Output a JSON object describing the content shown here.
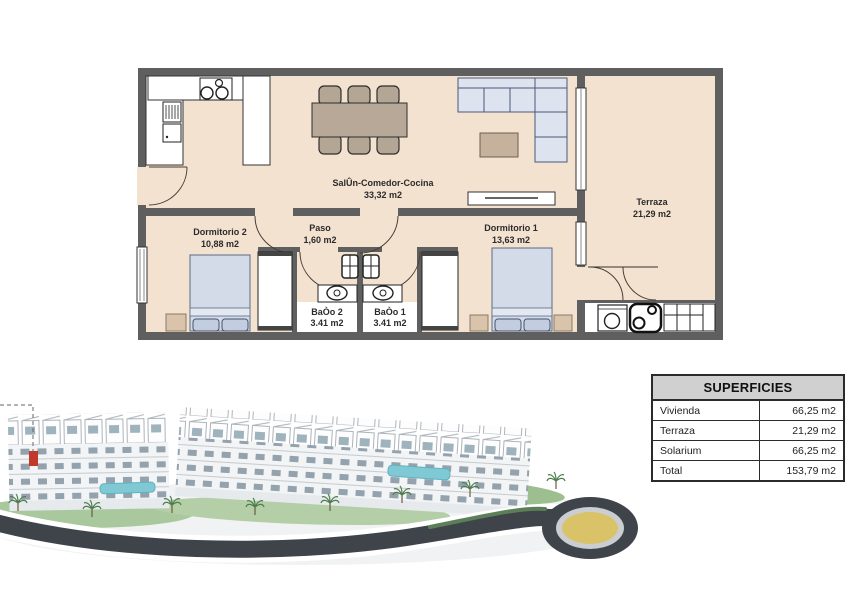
{
  "plan": {
    "rooms": {
      "salon": {
        "name": "SalÛn-Comedor-Cocina",
        "area": "33,32 m2"
      },
      "paso": {
        "name": "Paso",
        "area": "1,60 m2"
      },
      "dormitorio2": {
        "name": "Dormitorio 2",
        "area": "10,88 m2"
      },
      "dormitorio1": {
        "name": "Dormitorio 1",
        "area": "13,63 m2"
      },
      "bano2": {
        "name": "BaÒo 2",
        "area": "3.41 m2"
      },
      "bano1": {
        "name": "BaÒo 1",
        "area": "3.41 m2"
      },
      "terraza": {
        "name": "Terraza",
        "area": "21,29 m2"
      }
    }
  },
  "superficies_table": {
    "title": "SUPERFICIES",
    "rows": [
      {
        "label": "Vivienda",
        "value": "66,25 m2"
      },
      {
        "label": "Terraza",
        "value": "21,29 m2"
      },
      {
        "label": "Solarium",
        "value": "66,25 m2"
      },
      {
        "label": "Total",
        "value": "153,79 m2"
      }
    ]
  },
  "colors": {
    "floor": "#f4e2d1",
    "wall": "#5f5f5f",
    "furniture_blue": "#dbe1ed",
    "furniture_tan": "#c9b7a2",
    "highlight_red": "#c0392b",
    "pool": "#7fc9d4",
    "road": "#3f444a",
    "roundabout_center": "#d9c268",
    "table_header_bg": "#d0d0d0"
  }
}
